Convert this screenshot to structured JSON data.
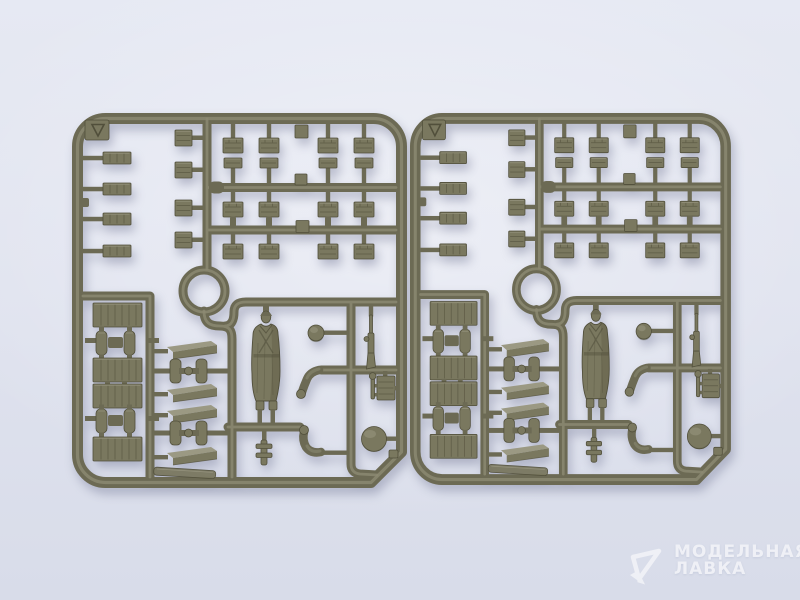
{
  "photo": {
    "kind": "product photograph",
    "subject": "Two identical olive-green injection-molded plastic sprues of a scale model kit on a pale blue-grey backdrop",
    "sprues": [
      {
        "id": "left",
        "position": "left half of frame"
      },
      {
        "id": "right",
        "position": "right half of frame"
      }
    ],
    "visible_parts": [
      "rows of small ammunition boxes",
      "flat lids and plates",
      "large planked crates",
      "wheel hub pairs",
      "wooden planks",
      "wheel-and-axle sets",
      "standing soldier figure in greatcoat",
      "separate bent arms",
      "helmeted head",
      "round helmet",
      "rifle",
      "ring-shaped runner",
      "triangle corner mark tab"
    ]
  },
  "watermark": {
    "line1": "МОДЕЛЬНАЯ",
    "line2": "ЛАВКА"
  },
  "colors": {
    "bg_top": "#e6e9f3",
    "bg_mid": "#e0e3ef",
    "bg_bottom": "#d8dce9",
    "plastic": "#6c6a54",
    "plastic_dark": "#514f3b",
    "plastic_light": "#8d8b73",
    "plastic_face": "#7a785f",
    "plastic_hi": "#9b9983",
    "watermark": "#ffffff"
  }
}
